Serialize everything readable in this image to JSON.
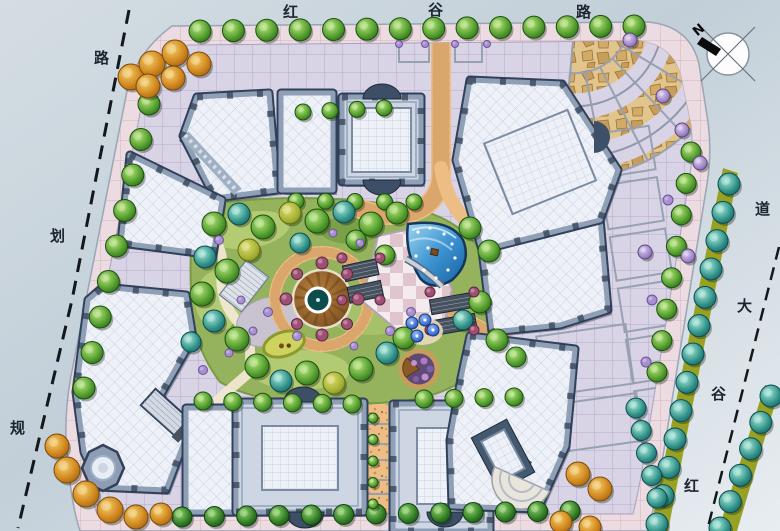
{
  "labels": {
    "top_road": {
      "name": "红谷路",
      "chars": [
        "红",
        "谷",
        "路"
      ]
    },
    "left_road": {
      "name": "规划路",
      "chars": [
        "规",
        "划",
        "路"
      ]
    },
    "right_road": {
      "name": "红谷大道",
      "chars": [
        "红",
        "谷",
        "大",
        "道"
      ]
    },
    "compass_n": "N"
  },
  "palette": {
    "road": "#c6d1d9",
    "sidewalk": "#ecdbe1",
    "paving": "#d9d3e6",
    "orange_path": "#ecbd85",
    "flag_stone": "#c79d5c",
    "lawn": "#95b35c",
    "water_deep": "#1f6fb5",
    "roof": "#edf1f8",
    "frame": "#7e90a8",
    "deck_wood": "#8a5a28",
    "median_green": "#97a224",
    "dash": "#14181c",
    "label_ink": "#1c2430"
  },
  "vegetation": {
    "rows": [
      {
        "from": [
          200,
          31
        ],
        "to": [
          634,
          26
        ],
        "n": 14,
        "r": 11,
        "type": "g"
      },
      {
        "from": [
          149,
          104
        ],
        "to": [
          84,
          388
        ],
        "n": 9,
        "r": 11,
        "type": "g"
      },
      {
        "from": [
          182,
          517
        ],
        "to": [
          570,
          511
        ],
        "n": 13,
        "r": 10,
        "type": "dg"
      },
      {
        "from": [
          691,
          152
        ],
        "to": [
          657,
          372
        ],
        "n": 8,
        "r": 10,
        "type": "g"
      },
      {
        "from": [
          729,
          184
        ],
        "to": [
          657,
          524
        ],
        "n": 13,
        "r": 11,
        "type": "b"
      },
      {
        "from": [
          771,
          396
        ],
        "to": [
          720,
          528
        ],
        "n": 6,
        "r": 11,
        "type": "b"
      },
      {
        "from": [
          203,
          401
        ],
        "to": [
          352,
          404
        ],
        "n": 6,
        "r": 9,
        "type": "g"
      },
      {
        "from": [
          424,
          399
        ],
        "to": [
          514,
          397
        ],
        "n": 4,
        "r": 9,
        "type": "g"
      },
      {
        "from": [
          303,
          112
        ],
        "to": [
          384,
          108
        ],
        "n": 4,
        "r": 8,
        "type": "g"
      },
      {
        "from": [
          296,
          201
        ],
        "to": [
          414,
          202
        ],
        "n": 5,
        "r": 8,
        "type": "g"
      },
      {
        "from": [
          636,
          408
        ],
        "to": [
          657,
          498
        ],
        "n": 5,
        "r": 10,
        "type": "b"
      },
      {
        "from": [
          373,
          418
        ],
        "to": [
          373,
          504
        ],
        "n": 5,
        "r": 5,
        "type": "g"
      }
    ],
    "trees": [
      [
        131,
        77,
        13,
        "or"
      ],
      [
        152,
        64,
        13,
        "or"
      ],
      [
        175,
        53,
        13,
        "or"
      ],
      [
        199,
        64,
        12,
        "or"
      ],
      [
        148,
        86,
        12,
        "or"
      ],
      [
        173,
        78,
        12,
        "or"
      ],
      [
        57,
        446,
        12,
        "or"
      ],
      [
        67,
        470,
        13,
        "or"
      ],
      [
        86,
        494,
        13,
        "or"
      ],
      [
        110,
        510,
        13,
        "or"
      ],
      [
        136,
        517,
        12,
        "or"
      ],
      [
        161,
        514,
        11,
        "or"
      ],
      [
        578,
        474,
        12,
        "or"
      ],
      [
        600,
        489,
        12,
        "or"
      ],
      [
        561,
        522,
        11,
        "or"
      ],
      [
        590,
        527,
        11,
        "or"
      ],
      [
        214,
        224,
        12,
        "g"
      ],
      [
        263,
        227,
        12,
        "g"
      ],
      [
        317,
        221,
        12,
        "g"
      ],
      [
        371,
        224,
        12,
        "g"
      ],
      [
        397,
        213,
        11,
        "g"
      ],
      [
        227,
        271,
        12,
        "g"
      ],
      [
        202,
        294,
        12,
        "g"
      ],
      [
        237,
        339,
        12,
        "g"
      ],
      [
        257,
        366,
        12,
        "g"
      ],
      [
        307,
        373,
        12,
        "g"
      ],
      [
        361,
        369,
        12,
        "g"
      ],
      [
        404,
        338,
        11,
        "g"
      ],
      [
        356,
        240,
        10,
        "g"
      ],
      [
        385,
        255,
        10,
        "g"
      ],
      [
        470,
        228,
        11,
        "g"
      ],
      [
        489,
        251,
        11,
        "g"
      ],
      [
        480,
        302,
        11,
        "g"
      ],
      [
        497,
        340,
        11,
        "g"
      ],
      [
        516,
        357,
        10,
        "g"
      ],
      [
        239,
        214,
        11,
        "b"
      ],
      [
        344,
        212,
        11,
        "b"
      ],
      [
        205,
        257,
        11,
        "b"
      ],
      [
        214,
        321,
        11,
        "b"
      ],
      [
        281,
        381,
        11,
        "b"
      ],
      [
        387,
        353,
        11,
        "b"
      ],
      [
        300,
        243,
        10,
        "b"
      ],
      [
        463,
        320,
        10,
        "b"
      ],
      [
        191,
        342,
        10,
        "b"
      ],
      [
        290,
        213,
        11,
        "ol"
      ],
      [
        249,
        250,
        11,
        "ol"
      ],
      [
        334,
        383,
        11,
        "ol"
      ],
      [
        630,
        40,
        7,
        "pu"
      ],
      [
        663,
        96,
        7,
        "pu"
      ],
      [
        682,
        130,
        7,
        "pu"
      ],
      [
        700,
        163,
        7,
        "pu"
      ],
      [
        645,
        252,
        7,
        "pu"
      ],
      [
        688,
        256,
        7,
        "pu"
      ]
    ],
    "shrubs": [
      [
        219,
        240,
        4.5,
        "pl"
      ],
      [
        268,
        312,
        4.5,
        "pl"
      ],
      [
        253,
        331,
        4,
        "pl"
      ],
      [
        297,
        336,
        4.5,
        "pl"
      ],
      [
        354,
        346,
        4,
        "pl"
      ],
      [
        390,
        331,
        4.5,
        "pl"
      ],
      [
        229,
        353,
        4,
        "pl"
      ],
      [
        333,
        233,
        4,
        "pl"
      ],
      [
        411,
        312,
        4.5,
        "pl"
      ],
      [
        360,
        243,
        4,
        "pl"
      ],
      [
        241,
        300,
        4,
        "pl"
      ],
      [
        203,
        370,
        4.5,
        "pl"
      ],
      [
        399,
        44,
        3.5,
        "pl"
      ],
      [
        425,
        44,
        3.5,
        "pl"
      ],
      [
        455,
        44,
        3.5,
        "pl"
      ],
      [
        487,
        44,
        3.5,
        "pl"
      ],
      [
        668,
        200,
        5,
        "pl"
      ],
      [
        652,
        300,
        5,
        "pl"
      ],
      [
        646,
        362,
        5,
        "pl"
      ],
      [
        286,
        299,
        6,
        "wi"
      ],
      [
        358,
        299,
        6,
        "wi"
      ],
      [
        322,
        263,
        6,
        "wi"
      ],
      [
        322,
        335,
        6,
        "wi"
      ],
      [
        297,
        274,
        5.5,
        "wi"
      ],
      [
        347,
        274,
        5.5,
        "wi"
      ],
      [
        297,
        324,
        5.5,
        "wi"
      ],
      [
        347,
        324,
        5.5,
        "wi"
      ],
      [
        342,
        258,
        5,
        "wi"
      ],
      [
        380,
        258,
        5,
        "wi"
      ],
      [
        342,
        300,
        5,
        "wi"
      ],
      [
        380,
        300,
        5,
        "wi"
      ],
      [
        430,
        292,
        5,
        "wi"
      ],
      [
        474,
        292,
        5,
        "wi"
      ],
      [
        430,
        330,
        5,
        "wi"
      ],
      [
        474,
        330,
        5,
        "wi"
      ]
    ],
    "umbrellas": [
      [
        412,
        323
      ],
      [
        425,
        320
      ],
      [
        433,
        330
      ],
      [
        417,
        336
      ]
    ]
  }
}
